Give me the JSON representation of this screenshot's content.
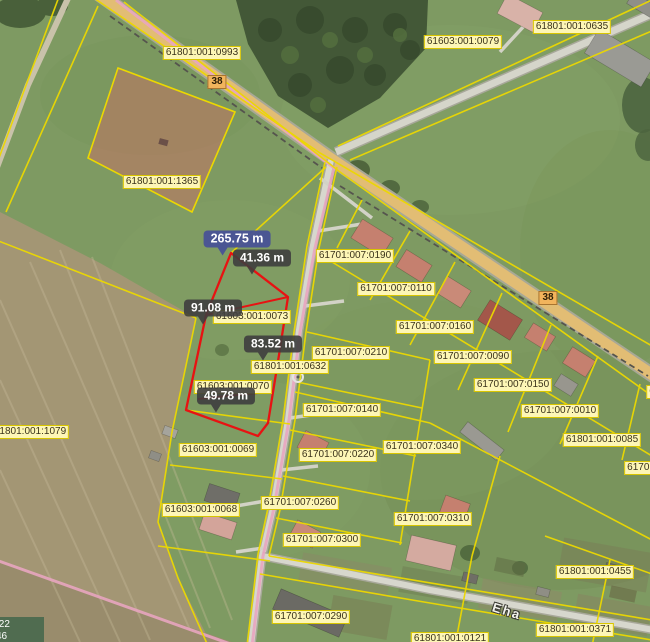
{
  "map": {
    "road_number_markers": [
      {
        "label": "38",
        "x": 217,
        "y": 82
      },
      {
        "label": "38",
        "x": 548,
        "y": 298
      }
    ],
    "street_labels": [
      {
        "text": "Eha",
        "x": 507,
        "y": 611
      }
    ],
    "parcel_labels": [
      {
        "code": "61801:001:0993",
        "x": 202,
        "y": 53
      },
      {
        "code": "61603:001:0079",
        "x": 463,
        "y": 42
      },
      {
        "code": "61801:001:0635",
        "x": 572,
        "y": 27
      },
      {
        "code": "61801:001:1365",
        "x": 162,
        "y": 182
      },
      {
        "code": "61701:007:0190",
        "x": 355,
        "y": 256
      },
      {
        "code": "61701:007:0110",
        "x": 396,
        "y": 289
      },
      {
        "code": "61603:001:0073",
        "x": 252,
        "y": 317
      },
      {
        "code": "61701:007:0160",
        "x": 435,
        "y": 327
      },
      {
        "code": "61701:007:0210",
        "x": 351,
        "y": 353
      },
      {
        "code": "61701:007:0090",
        "x": 473,
        "y": 357
      },
      {
        "code": "61801:001:0632",
        "x": 290,
        "y": 367
      },
      {
        "code": "61701:007:0150",
        "x": 513,
        "y": 385
      },
      {
        "code": "61603:001:0070",
        "x": 233,
        "y": 387
      },
      {
        "code": "6",
        "x": 652,
        "y": 392
      },
      {
        "code": "61701:007:0140",
        "x": 342,
        "y": 410
      },
      {
        "code": "61701:007:0010",
        "x": 560,
        "y": 411
      },
      {
        "code": "61801:001:1079",
        "x": 30,
        "y": 432
      },
      {
        "code": "61801:001:0085",
        "x": 602,
        "y": 440
      },
      {
        "code": "61701:007:0340",
        "x": 422,
        "y": 447
      },
      {
        "code": "61603:001:0069",
        "x": 218,
        "y": 450
      },
      {
        "code": "61701:007:0220",
        "x": 338,
        "y": 455
      },
      {
        "code": "61701:00",
        "x": 648,
        "y": 468
      },
      {
        "code": "61701:007:0260",
        "x": 300,
        "y": 503
      },
      {
        "code": "61603:001:0068",
        "x": 201,
        "y": 510
      },
      {
        "code": "61701:007:0310",
        "x": 433,
        "y": 519
      },
      {
        "code": "61701:007:0300",
        "x": 322,
        "y": 540
      },
      {
        "code": "61801:001:0455",
        "x": 595,
        "y": 572
      },
      {
        "code": "61701:007:0290",
        "x": 311,
        "y": 617
      },
      {
        "code": "61801:001:0371",
        "x": 575,
        "y": 630
      },
      {
        "code": "61801:001:0121",
        "x": 450,
        "y": 639
      }
    ],
    "measure_labels": {
      "total": {
        "text": "265.75 m",
        "x": 237,
        "y": 239
      },
      "segments": [
        {
          "text": "41.36 m",
          "x": 262,
          "y": 258
        },
        {
          "text": "91.08 m",
          "x": 213,
          "y": 308
        },
        {
          "text": "83.52 m",
          "x": 273,
          "y": 344
        },
        {
          "text": "49.78 m",
          "x": 226,
          "y": 396
        }
      ]
    },
    "measure_point": {
      "x": 298,
      "y": 377
    },
    "coordinate_readout": {
      "line1": ".22",
      "line2": "46"
    },
    "colors": {
      "parcel_boundary": "#ecd800",
      "parcel_label_bg": "#fdf6b6",
      "parcel_label_border": "#d8c500",
      "parcel_label_text": "#3a321a",
      "measure_line": "#e81212",
      "measure_label_bg": "rgba(62,62,62,0.9)",
      "measure_total_bg": "rgba(72,82,150,0.95)",
      "measure_label_text": "#ffffff",
      "road_marker_bg": "#f2b45c",
      "road_marker_border": "#a87430",
      "municipal_boundary": "#e8a6c0",
      "selected_parcel_fill": "rgba(202,112,100,0.5)"
    },
    "buildings": [
      {
        "x": 372,
        "y": 238,
        "w": 36,
        "h": 22,
        "r": 32,
        "c": "#c5806f"
      },
      {
        "x": 414,
        "y": 266,
        "w": 30,
        "h": 20,
        "r": 32,
        "c": "#c5806f"
      },
      {
        "x": 454,
        "y": 292,
        "w": 28,
        "h": 20,
        "r": 32,
        "c": "#c98a78"
      },
      {
        "x": 500,
        "y": 320,
        "w": 38,
        "h": 24,
        "r": 32,
        "c": "#a3574a"
      },
      {
        "x": 540,
        "y": 337,
        "w": 26,
        "h": 17,
        "r": 32,
        "c": "#c5806f"
      },
      {
        "x": 579,
        "y": 362,
        "w": 27,
        "h": 19,
        "r": 32,
        "c": "#c5806f"
      },
      {
        "x": 566,
        "y": 385,
        "w": 20,
        "h": 14,
        "r": 32,
        "c": "#98968e"
      },
      {
        "x": 313,
        "y": 445,
        "w": 26,
        "h": 19,
        "r": 28,
        "c": "#c5806f"
      },
      {
        "x": 455,
        "y": 508,
        "w": 26,
        "h": 18,
        "r": 20,
        "c": "#c5806f"
      },
      {
        "x": 305,
        "y": 534,
        "w": 26,
        "h": 18,
        "r": 28,
        "c": "#c98a78"
      },
      {
        "x": 482,
        "y": 441,
        "w": 46,
        "h": 13,
        "r": 38,
        "c": "#9a9992"
      },
      {
        "x": 222,
        "y": 497,
        "w": 32,
        "h": 18,
        "r": 18,
        "c": "#6f6e68"
      },
      {
        "x": 218,
        "y": 526,
        "w": 34,
        "h": 18,
        "r": 18,
        "c": "#d3a49a"
      },
      {
        "x": 170,
        "y": 432,
        "w": 14,
        "h": 9,
        "r": 20,
        "c": "#a5a49c"
      },
      {
        "x": 155,
        "y": 456,
        "w": 11,
        "h": 8,
        "r": 20,
        "c": "#8f8e86"
      },
      {
        "x": 431,
        "y": 553,
        "w": 46,
        "h": 26,
        "r": 13,
        "c": "#d4aaa0"
      },
      {
        "x": 310,
        "y": 613,
        "w": 72,
        "h": 22,
        "r": 23,
        "c": "#6b6a64"
      },
      {
        "x": 520,
        "y": 13,
        "w": 40,
        "h": 22,
        "r": 28,
        "c": "#d8b2a8"
      },
      {
        "x": 620,
        "y": 58,
        "w": 66,
        "h": 28,
        "r": 31,
        "c": "#9a9a94"
      },
      {
        "x": 642,
        "y": 5,
        "w": 28,
        "h": 13,
        "r": 31,
        "c": "#8f8f88"
      },
      {
        "x": 470,
        "y": 578,
        "w": 15,
        "h": 9,
        "r": 14,
        "c": "#6f6e66"
      },
      {
        "x": 543,
        "y": 592,
        "w": 13,
        "h": 8,
        "r": 14,
        "c": "#8f8e85"
      },
      {
        "x": 612,
        "y": 568,
        "w": 13,
        "h": 8,
        "r": 14,
        "c": "#6f6e66"
      }
    ]
  }
}
